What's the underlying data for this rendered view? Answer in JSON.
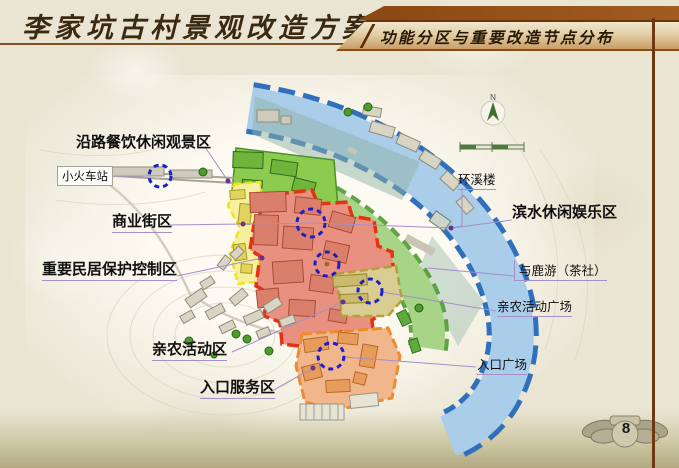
{
  "slide": {
    "title": "李家坑古村景观改造方案",
    "banner_title": "功能分区与重要改造节点分布",
    "page_number": "8"
  },
  "map": {
    "compass_n": "N",
    "labels": {
      "scenic_dining": "沿路餐饮休闲观景区",
      "train_station": "小火车站",
      "commercial_street": "商业街区",
      "residence_protection": "重要民居保护控制区",
      "farm_activity_zone": "亲农活动区",
      "entrance_service": "入口服务区",
      "huanxi_tower": "环溪楼",
      "waterfront_leisure": "滨水休闲娱乐区",
      "deer_teahouse": "与鹿游（茶社）",
      "farm_activity_plaza": "亲农活动广场",
      "entrance_plaza": "入口广场"
    },
    "colors": {
      "river_fill": "#aacdea",
      "river_border": "#2f6fbc",
      "waterfront_green": "#a8d488",
      "scenic_green": "#8ccb50",
      "commercial_yellow_fill": "#f6ef9e",
      "commercial_yellow_border": "#efe418",
      "protection_red_fill": "#e89180",
      "protection_red_border": "#e43312",
      "farm_khaki_fill": "#d9cd92",
      "farm_khaki_border": "#b2a138",
      "entrance_orange_fill": "#f2b68c",
      "entrance_orange_border": "#ee8c2c",
      "node_circle_blue": "#1e1ec8",
      "leader_purple": "#a48fc9",
      "header_brown": "#8a4a16"
    }
  }
}
